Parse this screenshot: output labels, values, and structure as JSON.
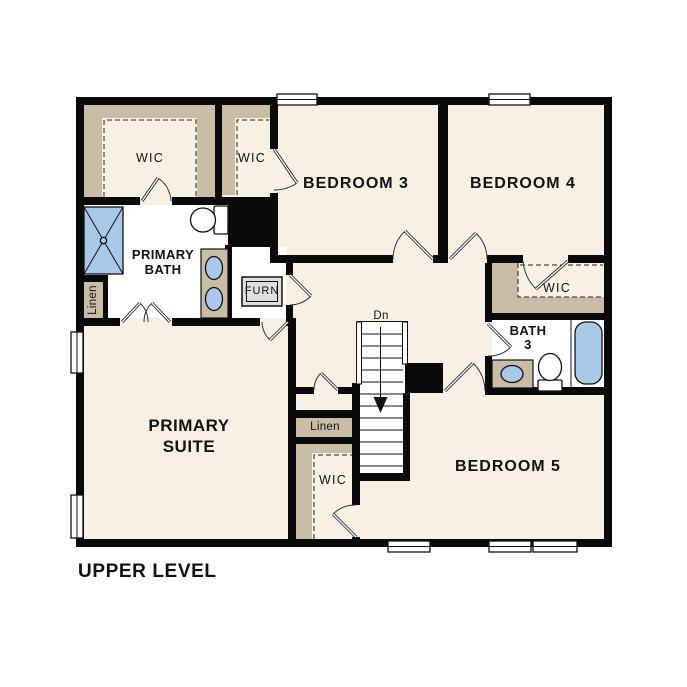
{
  "plan": {
    "title": "UPPER LEVEL",
    "level": "Upper Level floor plan",
    "labels": {
      "wic_primary": "WIC",
      "wic_bed3": "WIC",
      "bedroom3": "BEDROOM 3",
      "bedroom4": "BEDROOM 4",
      "primary_bath_line1": "PRIMARY",
      "primary_bath_line2": "BATH",
      "linen_bath": "Linen",
      "furnace": "FURN",
      "wic_bed4": "WIC",
      "bath3_line1": "BATH",
      "bath3_line2": "3",
      "stairs_down": "Dn",
      "primary_suite_line1": "PRIMARY",
      "primary_suite_line2": "SUITE",
      "linen_hall": "Linen",
      "wic_bed5": "WIC",
      "bedroom5": "BEDROOM 5"
    },
    "fixtures": [
      "shower",
      "toilet",
      "double-sink-vanity",
      "furnace-unit",
      "sink-vanity",
      "bathtub",
      "staircase",
      "down-arrow",
      "closet-shelving",
      "window",
      "door-swing"
    ],
    "colors": {
      "background": "#ffffff",
      "floor": "#f7f0e3",
      "bath_floor": "#ffffff",
      "shelving": "#c9bda6",
      "walls": "#0a0a0a",
      "fixtures": "#a9c9e9",
      "furnace_fill": "#dfdfdf",
      "text": "#121212"
    }
  }
}
